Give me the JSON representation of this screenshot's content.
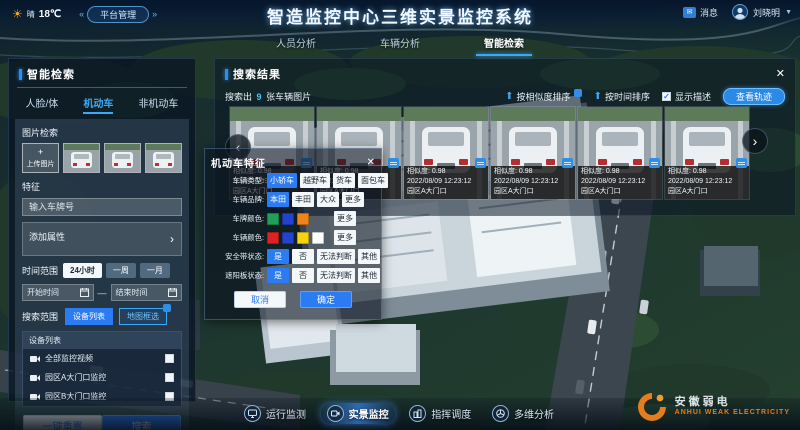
{
  "topbar": {
    "weather_condition": "晴",
    "temperature": "18℃",
    "platform_button": "平台管理",
    "title": "智造监控中心三维实景监控系统",
    "message_label": "消息",
    "user_name": "刘晓明"
  },
  "nav_tabs": [
    {
      "label": "人员分析"
    },
    {
      "label": "车辆分析"
    },
    {
      "label": "智能检索"
    }
  ],
  "search_panel": {
    "title": "智能检索",
    "tabs": [
      {
        "label": "人脸/体"
      },
      {
        "label": "机动车"
      },
      {
        "label": "非机动车"
      }
    ],
    "image_search_label": "图片检索",
    "upload_plus": "+",
    "upload_label": "上传图片",
    "feature_label": "特征",
    "plate_placeholder": "输入车牌号",
    "add_attribute_label": "添加属性",
    "time_range_label": "时间范围",
    "time_options": [
      "24小时",
      "一周",
      "一月"
    ],
    "start_time_placeholder": "开始时间",
    "end_time_placeholder": "结束时间",
    "scope_label": "搜索范围",
    "scope_device_list": "设备列表",
    "scope_map_select": "地图框选",
    "device_list_title": "设备列表",
    "devices": [
      {
        "name": "全部监控视频"
      },
      {
        "name": "园区A大门口监控"
      },
      {
        "name": "园区B大门口监控"
      }
    ],
    "reset_button": "一键重置",
    "search_button": "搜索"
  },
  "feature_popup": {
    "title": "机动车特征",
    "vehicle_type": {
      "label": "车辆类型:",
      "options": [
        "小轿车",
        "越野车",
        "货车",
        "面包车"
      ]
    },
    "brand": {
      "label": "车辆品牌:",
      "options": [
        "本田",
        "丰田",
        "大众",
        "更多"
      ]
    },
    "plate_color": {
      "label": "车牌颜色:",
      "colors": [
        "#1fa05a",
        "#2244cc",
        "#f08418"
      ],
      "more": "更多"
    },
    "vehicle_color": {
      "label": "车辆颜色:",
      "colors": [
        "#dd2222",
        "#2244cc",
        "#f5d312",
        "#ffffff"
      ],
      "more": "更多"
    },
    "seatbelt": {
      "label": "安全带状态:",
      "options": [
        "是",
        "否",
        "无法判断",
        "其他"
      ]
    },
    "sunvisor": {
      "label": "遮阳板状态:",
      "options": [
        "是",
        "否",
        "无法判断",
        "其他"
      ]
    },
    "cancel_button": "取消",
    "confirm_button": "确定"
  },
  "results_panel": {
    "title": "搜索结果",
    "summary_prefix": "搜索出",
    "summary_count": "9",
    "summary_suffix": "张车辆图片",
    "sort_similarity": "按相似度排序",
    "sort_time": "按时间排序",
    "show_description": "显示描述",
    "show_description_checked": "✓",
    "view_track_button": "查看轨迹",
    "cards": [
      {
        "similarity": "相似度: 0.98",
        "time": "2022/08/09 12:23:12",
        "location": "园区A大门口"
      },
      {
        "similarity": "相似度: 0.98",
        "time": "2022/08/09 12:23:12",
        "location": "园区A大门口"
      },
      {
        "similarity": "相似度: 0.98",
        "time": "2022/08/09 12:23:12",
        "location": "园区A大门口"
      },
      {
        "similarity": "相似度: 0.98",
        "time": "2022/08/09 12:23:12",
        "location": "园区A大门口"
      },
      {
        "similarity": "相似度: 0.98",
        "time": "2022/08/09 12:23:12",
        "location": "园区A大门口"
      },
      {
        "similarity": "相似度: 0.98",
        "time": "2022/08/09 12:23:12",
        "location": "园区A大门口"
      }
    ]
  },
  "bottom_nav": [
    {
      "label": "运行监测"
    },
    {
      "label": "实景监控"
    },
    {
      "label": "指挥调度"
    },
    {
      "label": "多维分析"
    }
  ],
  "watermark": {
    "cn": "安徽弱电",
    "en": "ANHUI WEAK ELECTRICITY"
  },
  "colors": {
    "accent_blue": "#2b7bf3",
    "highlight_cyan": "#4dc3ff",
    "watermark_orange": "#f0821e"
  }
}
